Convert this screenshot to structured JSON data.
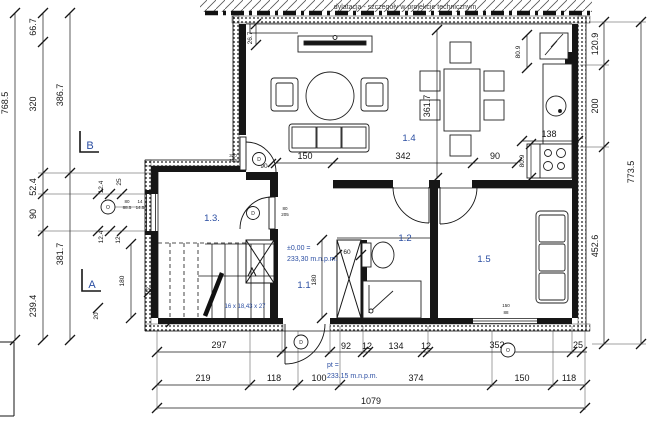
{
  "colors": {
    "accent_blue": "#2b4ea2",
    "line": "#161616"
  },
  "notes": {
    "dylatacja": "dylatacja - szczegóły w projekcie technicznym",
    "level_zero_1": "±0,00 =",
    "level_zero_2": "233,30 m.n.p.m.",
    "level_pt_1": "pt =",
    "level_pt_2": "233.15  m.n.p.m.",
    "stairs": "16 x 18,43 x 27"
  },
  "sections": {
    "a": "A",
    "b": "B"
  },
  "rooms": {
    "r11": "1.1",
    "r12": "1.2",
    "r13": "1.3.",
    "r14": "1.4",
    "r15": "1.5"
  },
  "markers": {
    "door": "D",
    "window": "O"
  },
  "dims": {
    "left_total": "768.5",
    "l66_7": "66.7",
    "l320": "320",
    "l52_4": "52.4",
    "l90": "90",
    "l239_4": "239.4",
    "l386_7": "386.7",
    "l381_7": "381.7",
    "t26_7": "26.7",
    "r120_9": "120.9",
    "r200": "200",
    "r452_6": "452.6",
    "right_total": "773.5",
    "i150": "150",
    "i342": "342",
    "i90": "90",
    "i361_7": "361.7",
    "k80_9a": "80.9",
    "k138": "138",
    "k80_9b": "80.9",
    "w12_4a": "12.4",
    "w25a": "25",
    "w12_4b": "12.4",
    "w12": "12",
    "s180": "180",
    "s20": "20",
    "s25": "25",
    "s20b": "20",
    "b180": "180",
    "b60": "60",
    "td90": "90",
    "td320": "320",
    "td235": "235",
    "dd80": "80",
    "dd205": "205",
    "wf80": "80",
    "wf88_5": "88.5",
    "wf14": "14",
    "wf14_5": "14.5",
    "wb150": "150",
    "wb88": "88",
    "c297": "297",
    "c92": "92",
    "c12a": "12",
    "c134": "134",
    "c12b": "12",
    "c352": "352",
    "c25": "25",
    "c219": "219",
    "c118a": "118",
    "c100": "100",
    "c374": "374",
    "c150": "150",
    "c118b": "118",
    "total": "1079"
  }
}
